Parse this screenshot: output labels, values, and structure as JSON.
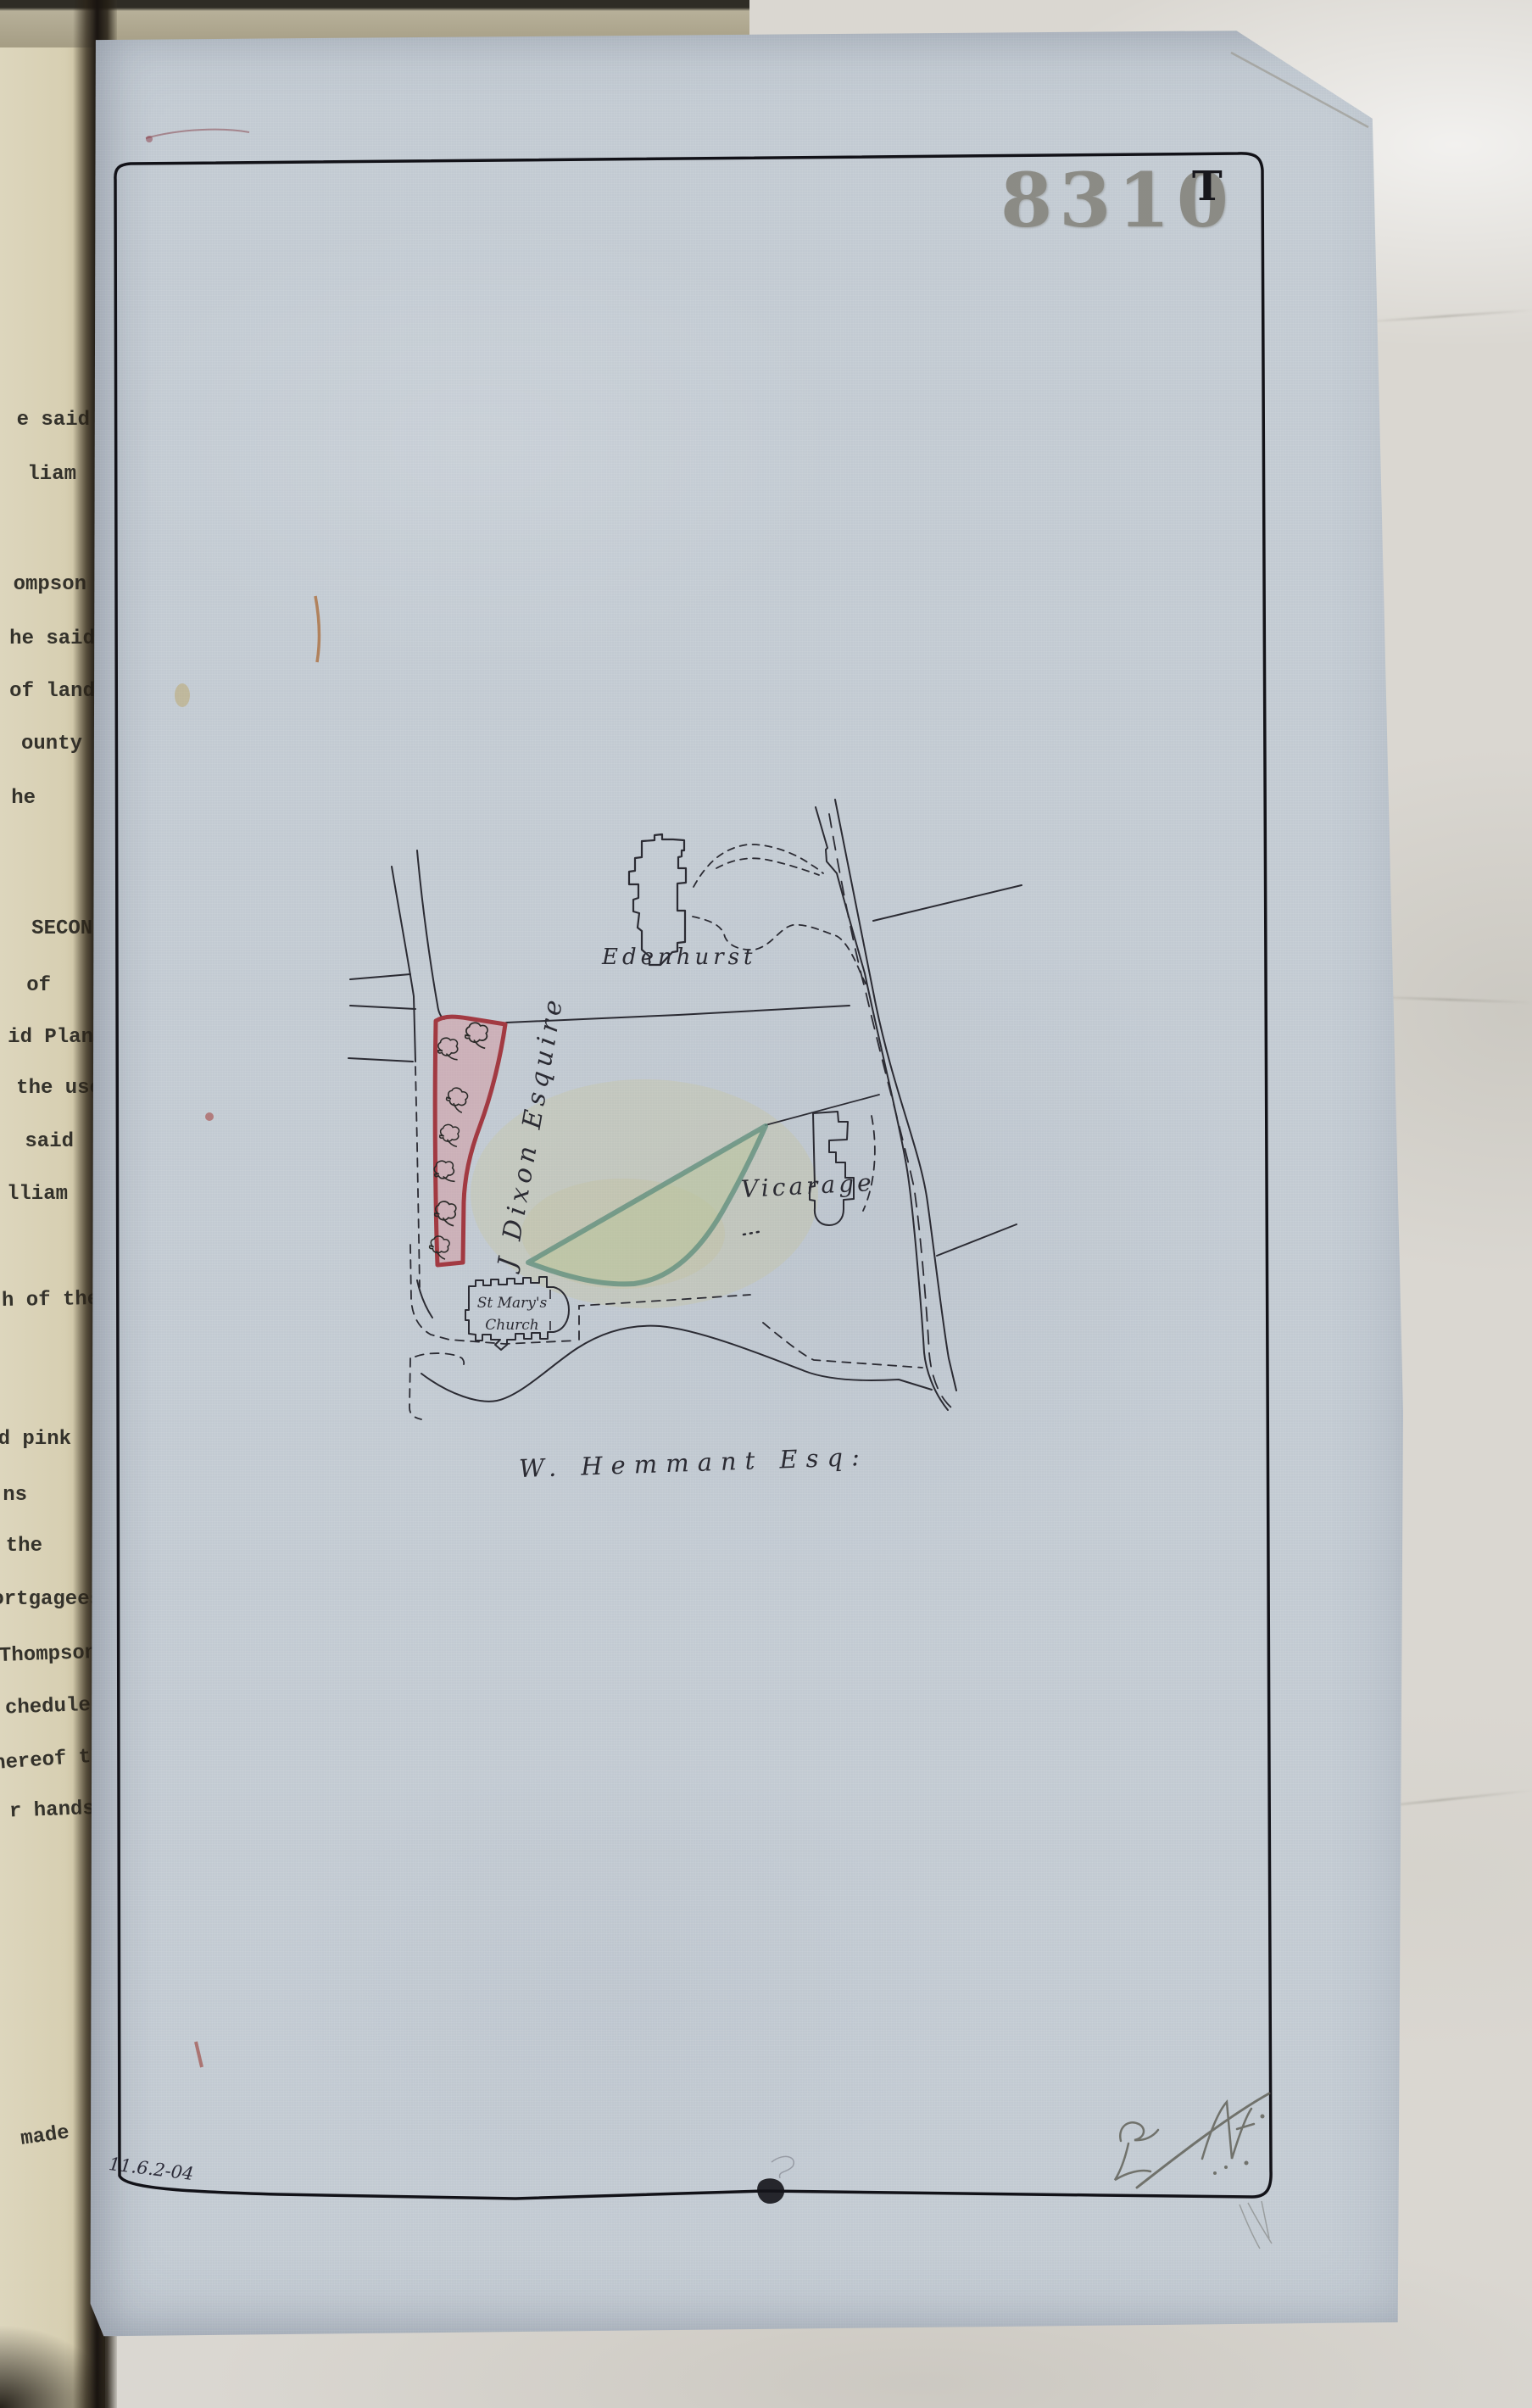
{
  "stamp": {
    "number": "8310",
    "suffix": "T"
  },
  "map_labels": {
    "estate_north": "Edenhurst",
    "owner_west": "J Dixon Esquire",
    "vicarage": "Vicarage",
    "church_line1": "St Mary's",
    "church_line2": "Church",
    "owner_south": "W. Hemmant Esq:"
  },
  "annotations": {
    "date_note": "11.6.2-04"
  },
  "colors": {
    "plan_paper": "#c2cad2",
    "plot_pink_fill": "#d98f97",
    "plot_pink_outline": "#a23a42",
    "plot_green_fill": "#b9c69c",
    "plot_green_outline": "#639080",
    "ink": "#2b2b33",
    "stamp_grey": "#84837b"
  },
  "left_page_fragments": [
    "e said",
    "liam",
    "ompson",
    "he said",
    "of land",
    "ounty",
    "he",
    "SECONDL",
    "of",
    "id Plan",
    "the use",
    "said",
    "lliam",
    "h of the",
    "d pink",
    "ns",
    "the",
    "ortgagees",
    "Thompson",
    "chedule",
    "hereof th",
    "r hands",
    "made"
  ]
}
